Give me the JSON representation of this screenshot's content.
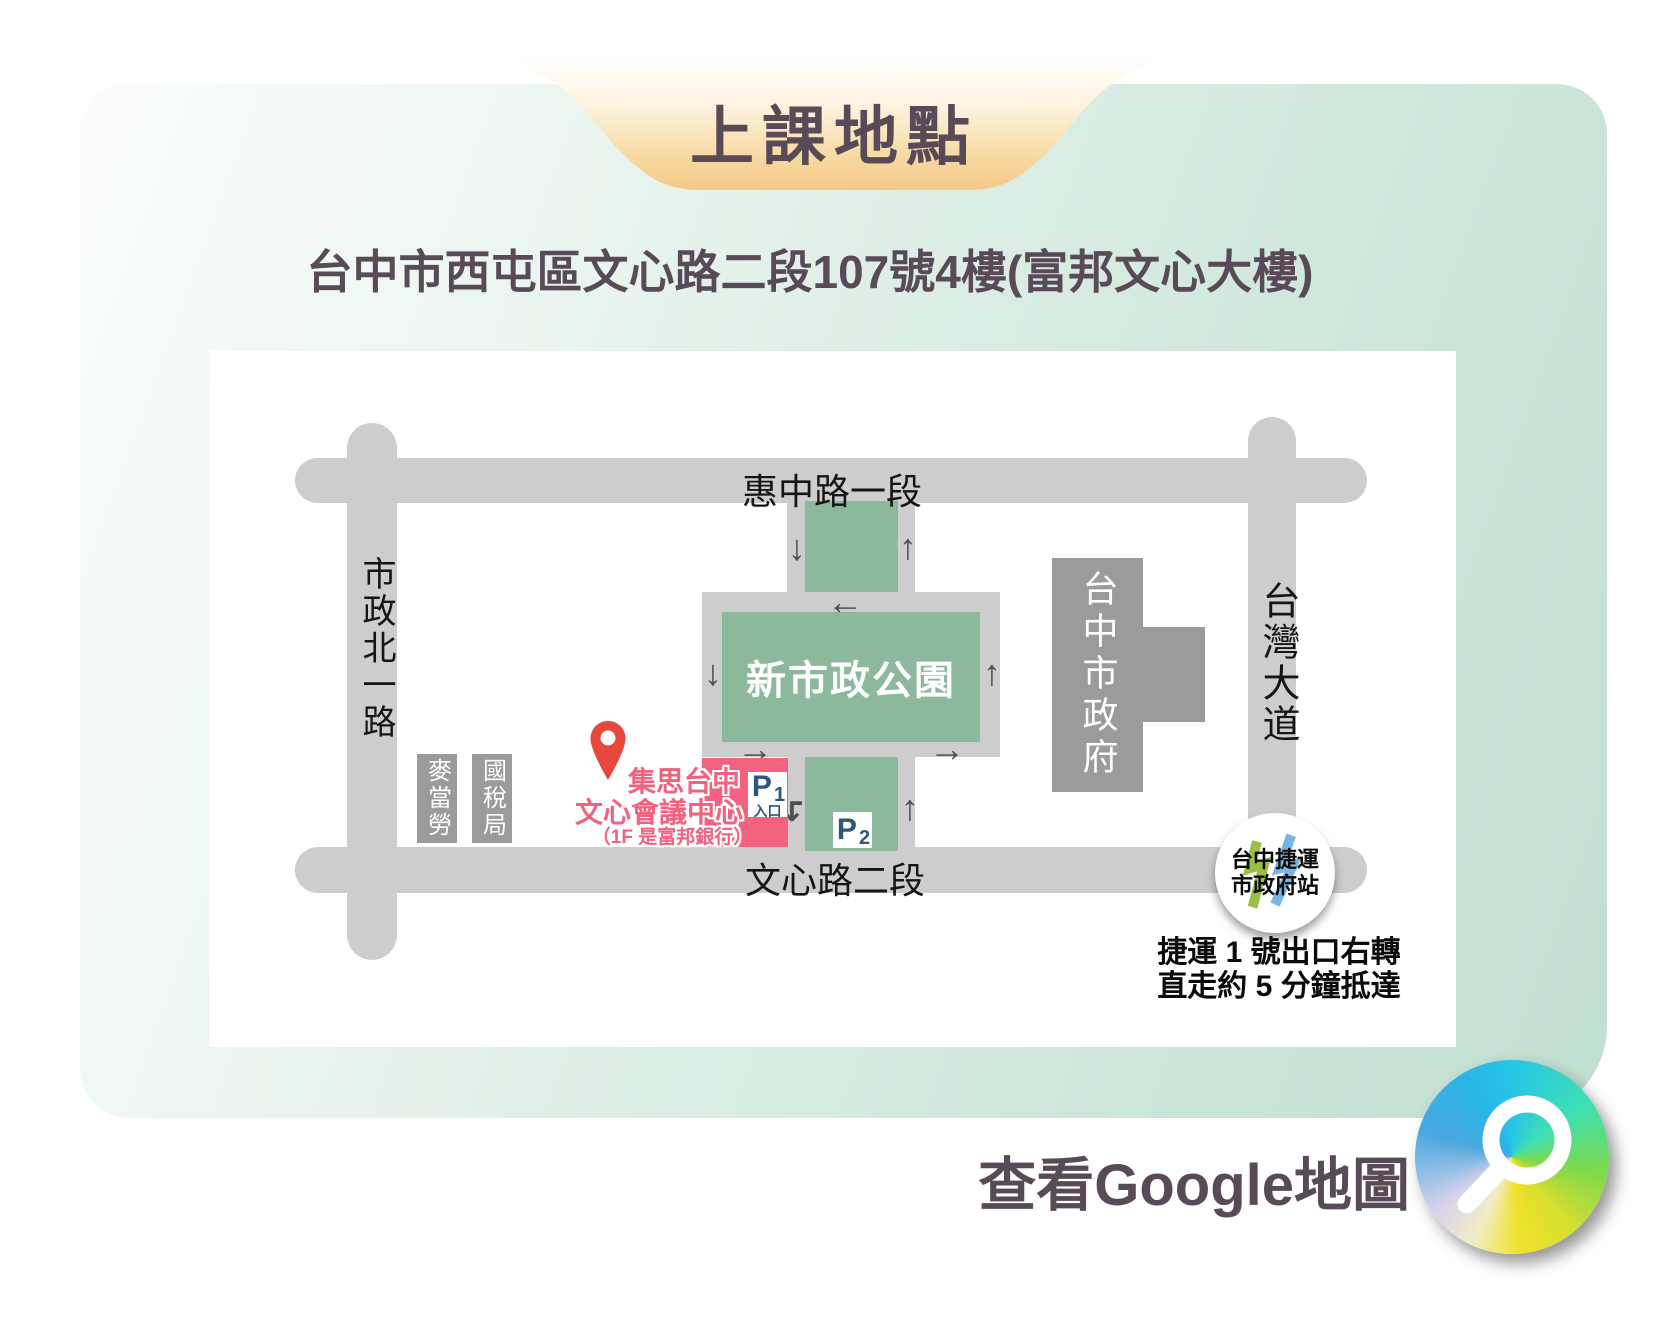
{
  "title_banner": {
    "title": "上課地點"
  },
  "address": "台中市西屯區文心路二段107號4樓(富邦文心大樓)",
  "map": {
    "roads": {
      "top": "惠中路一段",
      "bottom": "文心路二段",
      "left": "市政北一路",
      "right": "台灣大道"
    },
    "park_label": "新市政公園",
    "buildings": {
      "mcdonalds": "麥當勞",
      "tax_bureau": "國稅局",
      "city_hall": "台中市政府"
    },
    "venue": {
      "name_line1": "集思台中",
      "name_line2": "文心會議中心",
      "name_line3": "（1F 是富邦銀行）",
      "p1_letter": "P",
      "p1_number": "1",
      "p1_entrance_label": "入口",
      "p2_letter": "P",
      "p2_number": "2"
    },
    "arrows": [
      "↓",
      "↑",
      "←",
      "↓",
      "↑",
      "→",
      "→",
      "↴",
      "↑"
    ],
    "mrt_station": {
      "line1": "台中捷運",
      "line2": "市政府站"
    },
    "directions": {
      "line1": "捷運 1 號出口右轉",
      "line2": "直走約 5 分鐘抵達"
    }
  },
  "footer": {
    "google_maps_label": "查看Google地圖"
  },
  "colors": {
    "road_gray": "#cdcdcd",
    "building_gray": "#9b9b9b",
    "park_green": "#8cb99b",
    "venue_pink": "#f2617d",
    "parking_navy": "#2e567f",
    "heading_purple": "#594a57",
    "pin_red": "#e8473c",
    "mrt_green": "#9bbf44",
    "mrt_blue": "#7ab4e3",
    "banner_orange": "#f5cd8c",
    "panel_mint": "#bfdfd1"
  }
}
